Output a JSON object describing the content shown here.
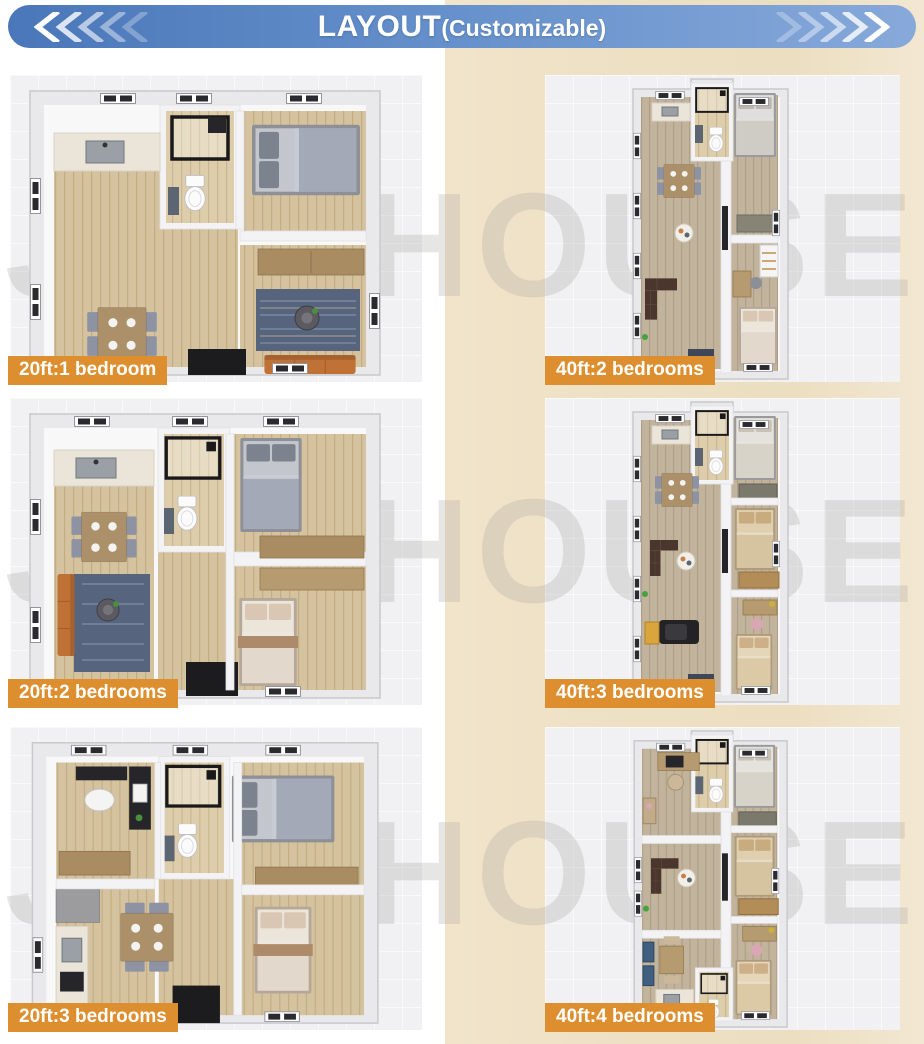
{
  "header": {
    "title": "LAYOUT",
    "subtitle": "(Customizable)"
  },
  "watermark": "JOY HOUSE",
  "plans": [
    {
      "id": "20ft-1-bedroom",
      "label": "20ft:1 bedroom"
    },
    {
      "id": "40ft-2-bedrooms",
      "label": "40ft:2 bedrooms"
    },
    {
      "id": "20ft-2-bedrooms",
      "label": "20ft:2 bedrooms"
    },
    {
      "id": "40ft-3-bedrooms",
      "label": "40ft:3 bedrooms"
    },
    {
      "id": "20ft-3-bedrooms",
      "label": "20ft:3 bedrooms"
    },
    {
      "id": "40ft-4-bedrooms",
      "label": "40ft:4 bedrooms"
    }
  ],
  "colors": {
    "banner_blue_start": "#4a77b9",
    "banner_blue_end": "#87a9da",
    "label_bg": "#dd8e2e",
    "background_beige": "#eee0c4",
    "panel_bg": "#f1f1f3",
    "watermark_gray": "#a7a4a0"
  }
}
